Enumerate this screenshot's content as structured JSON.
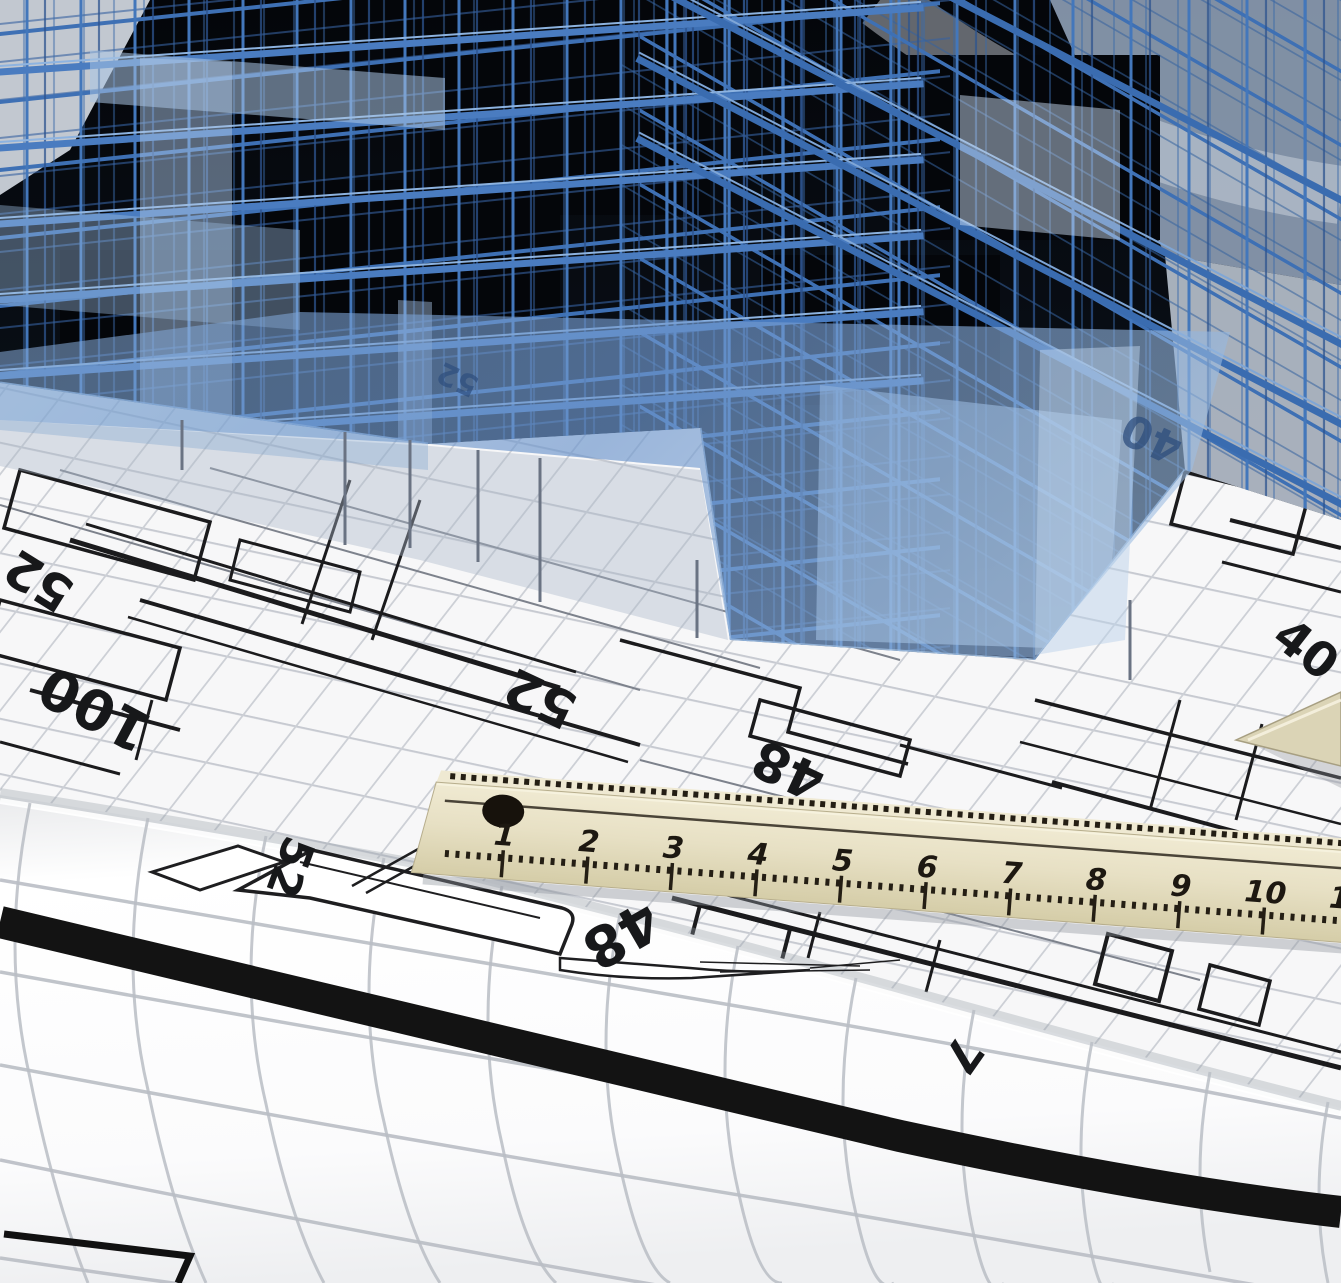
{
  "scene": {
    "title": "Translucent blue 3D wireframe building model standing on rolled architectural blueprint drawings with a wooden ruler",
    "colors": {
      "wireframe_blue": "#3e70b4",
      "wireframe_light": "#4377bb",
      "wireframe_dark": "#2c548f",
      "panel_blue": "#a9c4e4",
      "model_void": "#06080d",
      "slab_overlay": "#6e96cc",
      "paper": "#f7f7f8",
      "grid_line": "#c7cad1",
      "plan_line": "#1b1b1d",
      "ruler_wood": "#e7e0c4",
      "ruler_tick": "#241e14",
      "border_stripe": "#131313"
    }
  },
  "blueprint_annotations": [
    {
      "id": "dim-52-left-edge",
      "label": "52"
    },
    {
      "id": "dim-100-left",
      "label": "100"
    },
    {
      "id": "dim-52-center",
      "label": "52"
    },
    {
      "id": "dim-48-center",
      "label": "48"
    },
    {
      "id": "dim-40-right",
      "label": "40"
    },
    {
      "id": "dim-40-under-slab",
      "label": "40"
    },
    {
      "id": "dim-52-under-slab",
      "label": "52"
    },
    {
      "id": "dim-52-lower-sheet",
      "label": "52"
    },
    {
      "id": "dim-48-lower-sheet",
      "label": "48"
    },
    {
      "id": "dim-7-lower-sheet",
      "label": "7"
    }
  ],
  "ruler": {
    "numbers": [
      "1",
      "2",
      "3",
      "4",
      "5",
      "6",
      "7",
      "8",
      "9",
      "10",
      "11"
    ]
  }
}
